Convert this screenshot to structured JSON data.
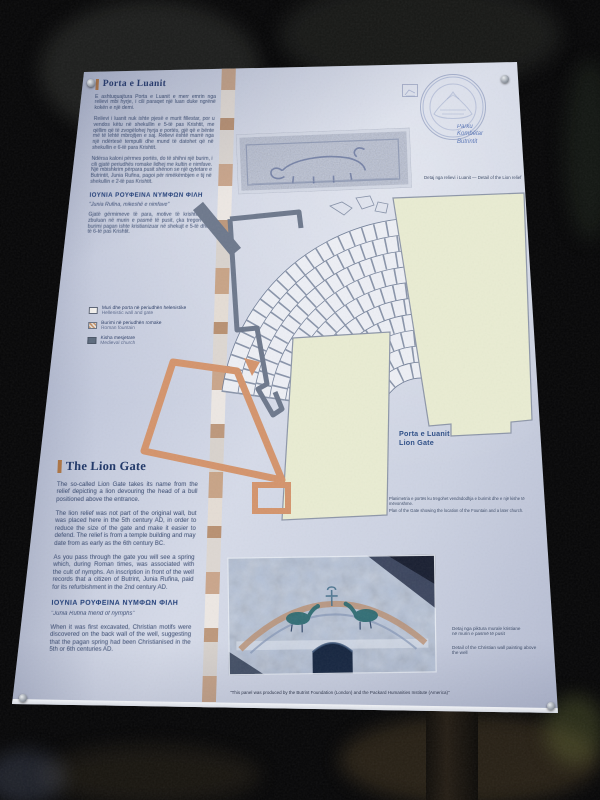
{
  "panel": {
    "albanian_section": {
      "title": "Porta e Luanit",
      "paragraphs": [
        "E ashtuquajtura Porta e Luanit e merr emrin nga relievi mbi hyrje, i cili paraqet një luan duke ngrënë kokën e një demi.",
        "Relievi i luanit nuk ishte pjesë e murit fillestar, por u vendos këtu në shekullin e 5-të pas Krishtit, me qëllim që të zvogëlohej hyrja e portës, gjë që e bënte më të lehtë mbrojtjen e saj. Relievi është marrë nga një ndërtesë tempulli dhe mund të datohet që në shekullin e 6-të para Krishtit.",
        "Ndërsa kaloni përmes portës, do të shihni një burim, i cili gjatë periudhës romake lidhej me kultin e nimfave. Një mbishkrim përpara pusit shënon se një qytetare e Butrintit, Junia Rufina, pagoi për rimëkëmbjen e tij në shekullin e 2-të pas Krishtit."
      ],
      "greek_heading": "ΙΟΥΝΙΑ ΡΟΥΦΕΙΝΑ ΝΥΜΦΩΝ ΦΙΛΗ",
      "quote": "\"Junia Rufina, mikeshë e nimfave\"",
      "closing_paragraph": "Gjatë gërmimeve të para, motive të krishtera u zbuluan në murin e pasmë të pusit, çka tregon se burimi pagan ishte kristianizuar në shekujt e 5-të dhe të 6-të pas Krishtit."
    },
    "english_section": {
      "title": "The Lion Gate",
      "paragraphs": [
        "The so-called Lion Gate takes its name from the relief depicting a lion devouring the head of a bull positioned above the entrance.",
        "The lion relief was not part of the original wall, but was placed here in the 5th century AD, in order to reduce the size of the gate and make it easier to defend. The relief is from a temple building and may date from as early as the 6th century BC.",
        "As you pass through the gate you will see a spring which, during Roman times, was associated with the cult of nymphs. An inscription in front of the well records that a citizen of Butrint, Junia Rufina, paid for its refurbishment in the 2nd century AD."
      ],
      "greek_heading": "ΙΟΥΝΙΑ ΡΟΥΦΕΙΝΑ ΝΥΜΦΩΝ ΦΙΛΗ",
      "quote": "\"Junia Rufina friend of nymphs\"",
      "closing_paragraph": "When it was first excavated, Christian motifs were discovered on the back wall of the well, suggesting that the pagan spring had been Christianised in the 5th or 6th centuries AD."
    },
    "legend": {
      "items": [
        {
          "sq": "Muri dhe porta në periudhën helenistike",
          "en": "Hellenistic wall and gate"
        },
        {
          "sq": "Burimi në periudhën romake",
          "en": "Roman fountain"
        },
        {
          "sq": "Kisha mesjetare",
          "en": "Medieval church"
        }
      ]
    },
    "logo": {
      "line1": "Parku",
      "line2": "Kombëtar",
      "line3": "Butrintit"
    },
    "plan": {
      "label_sq": "Porta e Luanit",
      "label_en": "Lion Gate",
      "caption_sq": "Planimetria e portës ku tregohet vendndodhja e burimit dhe e një kishe të mëvonshme.",
      "caption_en": "Plan of the Gate showing the location of the Fountain and a later church."
    },
    "relief_caption": {
      "sq": "Detaj nga relievi i Luanit",
      "en": "Detail of the Lion relief"
    },
    "painting_caption": {
      "sq_line1": "Detaj nga piktura murale kristiane",
      "sq_line2": "në murin e pasmë të pusit",
      "en": "Detail of the Christian wall painting above the well"
    },
    "credit": "\"This panel was produced by the Butrint Foundation (London) and the Packard Humanities Institute (America)\""
  },
  "colors": {
    "heading_navy": "#21366b",
    "accent_bar_tan": "#b5773f",
    "hellenistic_block_green": "#e9ecd2",
    "roman_fountain_salmon": "#d4946c",
    "medieval_church_gray": "#6d788c",
    "panel_light_blue": "#ccd2e2"
  }
}
